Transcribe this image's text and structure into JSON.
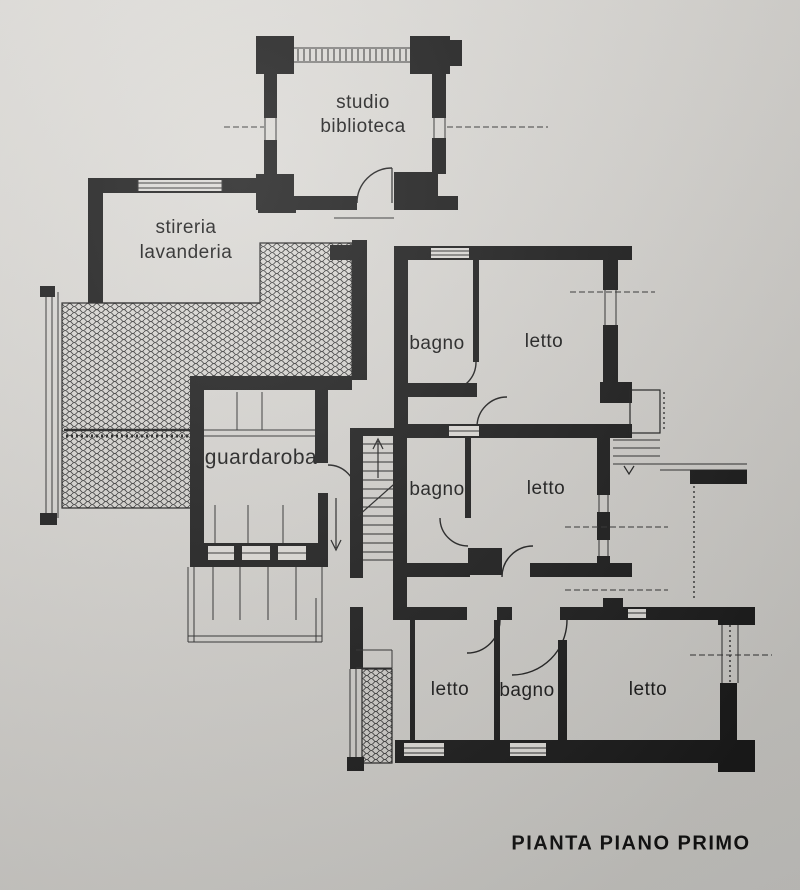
{
  "plan": {
    "title": "PIANTA PIANO PRIMO",
    "labels": {
      "studio_line1": "studio",
      "studio_line2": "biblioteca",
      "stireria_line1": "stireria",
      "stireria_line2": "lavanderia",
      "guardaroba": "guardaroba",
      "bagno_nord": "bagno",
      "letto_nord": "letto",
      "bagno_centro": "bagno",
      "letto_centro": "letto",
      "letto_sud_ovest": "letto",
      "bagno_sud": "bagno",
      "letto_sud_est": "letto"
    },
    "colors": {
      "ink": "#1a1a1a",
      "paper_light": "#e0deda",
      "paper_dark": "#c3c2be"
    }
  }
}
